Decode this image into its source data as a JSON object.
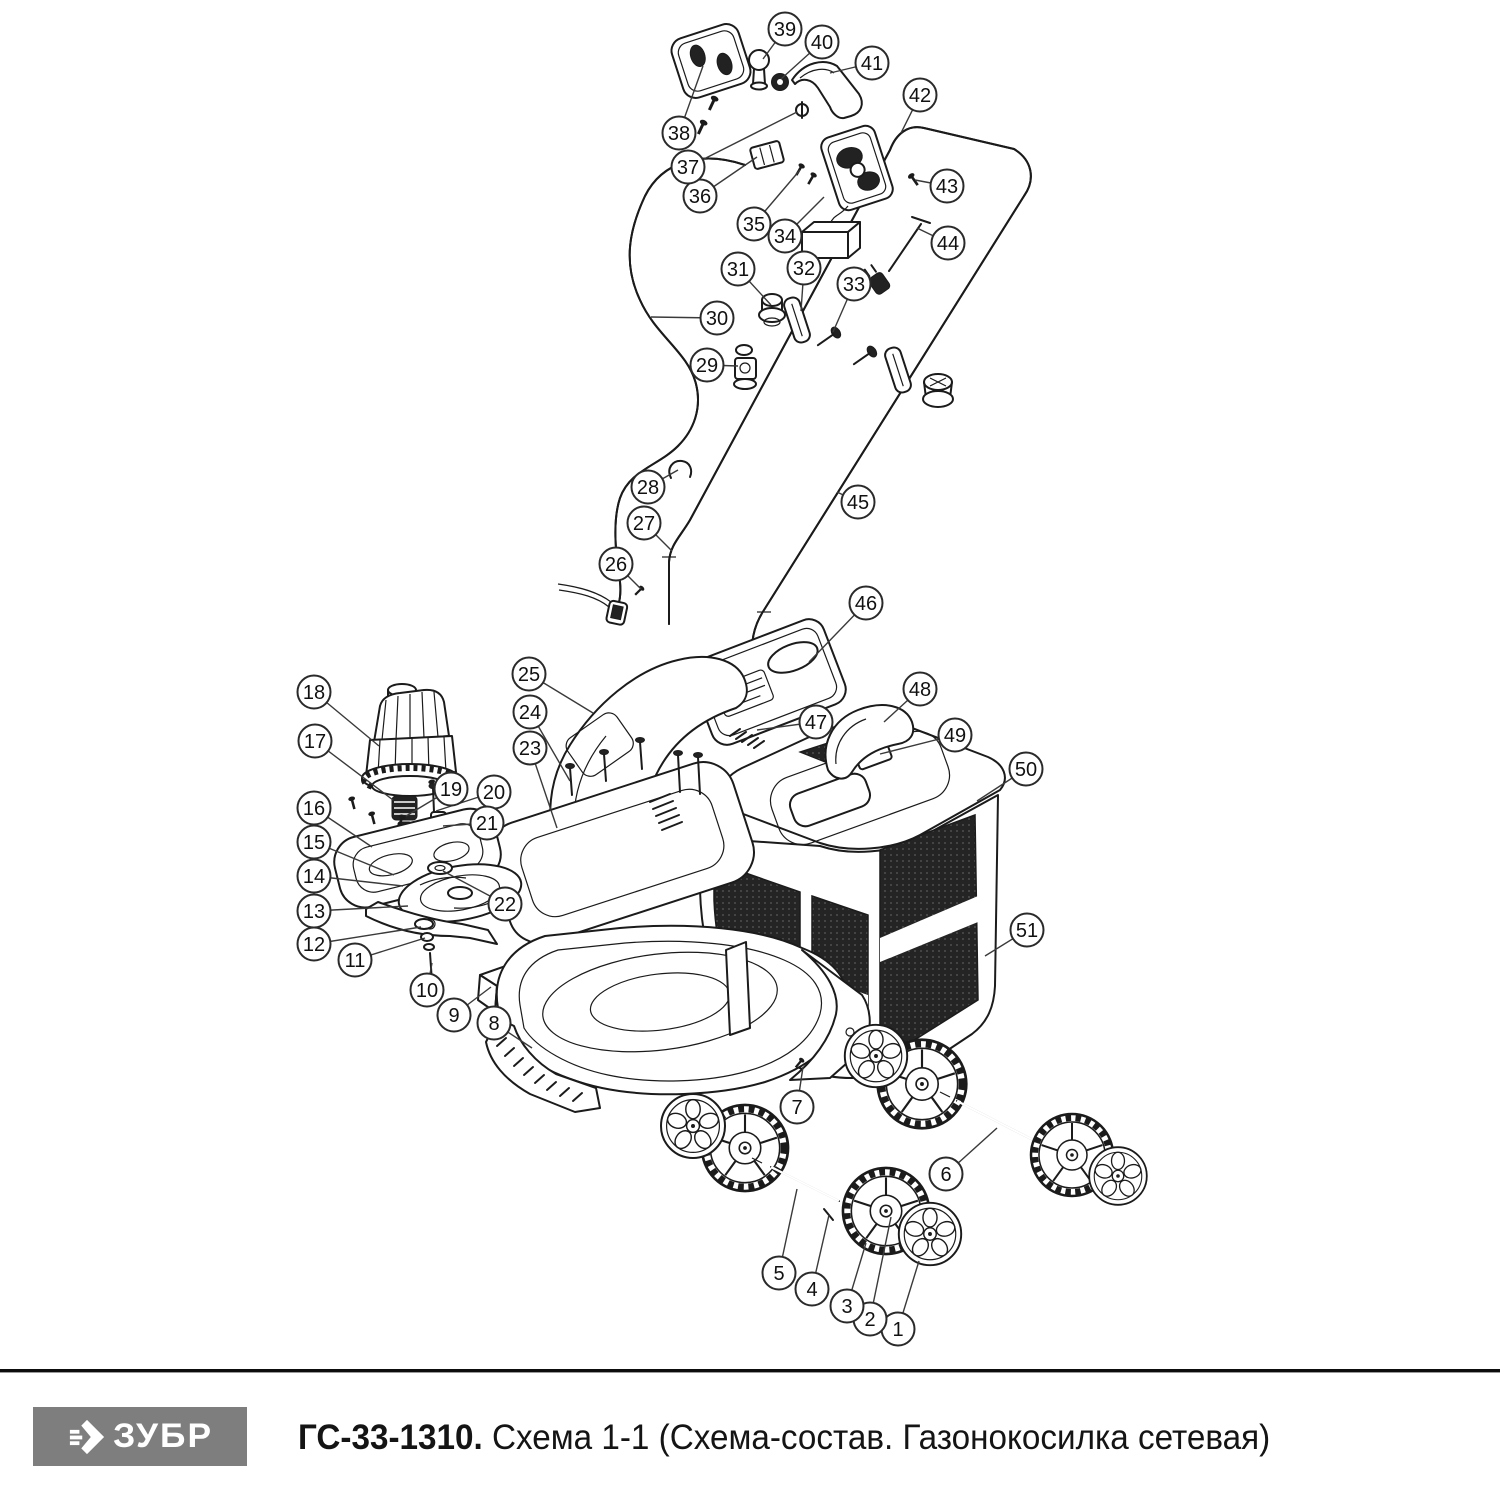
{
  "footer": {
    "brand": "ЗУБР",
    "model": "ГС-33-1310.",
    "scheme_title": " Схема 1-1 (Схема-состав. Газонокосилка сетевая)",
    "brand_bg": "#7e7e7e",
    "brand_fg": "#ffffff"
  },
  "diagram": {
    "kind": "exploded-parts-diagram",
    "subject": "Газонокосилка сетевая",
    "callout_style": {
      "radius": 16.5,
      "circle_color": "#2a2a2a",
      "text_color": "#111111",
      "leader_color": "#3a3a3a"
    },
    "callouts": [
      {
        "n": 1,
        "cx": 898,
        "cy": 1329,
        "tx": 919,
        "ty": 1261
      },
      {
        "n": 2,
        "cx": 870,
        "cy": 1319,
        "tx": 891,
        "ty": 1217
      },
      {
        "n": 3,
        "cx": 847,
        "cy": 1306,
        "tx": 866,
        "ty": 1243
      },
      {
        "n": 4,
        "cx": 812,
        "cy": 1289,
        "tx": 829,
        "ty": 1215
      },
      {
        "n": 5,
        "cx": 779,
        "cy": 1273,
        "tx": 797,
        "ty": 1189
      },
      {
        "n": 6,
        "cx": 946,
        "cy": 1174,
        "tx": 997,
        "ty": 1128
      },
      {
        "n": 7,
        "cx": 797,
        "cy": 1107,
        "tx": 803,
        "ty": 1067
      },
      {
        "n": 8,
        "cx": 494,
        "cy": 1023,
        "tx": 532,
        "ty": 1048
      },
      {
        "n": 9,
        "cx": 454,
        "cy": 1015,
        "tx": 491,
        "ty": 987
      },
      {
        "n": 10,
        "cx": 427,
        "cy": 990,
        "tx": 432,
        "ty": 963
      },
      {
        "n": 11,
        "cx": 355,
        "cy": 960,
        "tx": 425,
        "ty": 938
      },
      {
        "n": 12,
        "cx": 314,
        "cy": 944,
        "tx": 421,
        "ty": 927
      },
      {
        "n": 13,
        "cx": 314,
        "cy": 911,
        "tx": 408,
        "ty": 906
      },
      {
        "n": 14,
        "cx": 314,
        "cy": 876,
        "tx": 403,
        "ty": 886
      },
      {
        "n": 15,
        "cx": 314,
        "cy": 842,
        "tx": 394,
        "ty": 875
      },
      {
        "n": 16,
        "cx": 314,
        "cy": 808,
        "tx": 372,
        "ty": 847
      },
      {
        "n": 17,
        "cx": 315,
        "cy": 741,
        "tx": 393,
        "ty": 800
      },
      {
        "n": 18,
        "cx": 314,
        "cy": 692,
        "tx": 379,
        "ty": 746
      },
      {
        "n": 19,
        "cx": 451,
        "cy": 789,
        "tx": 406,
        "ty": 816
      },
      {
        "n": 20,
        "cx": 494,
        "cy": 792,
        "tx": 436,
        "ty": 811
      },
      {
        "n": 21,
        "cx": 487,
        "cy": 823,
        "tx": 443,
        "ty": 826
      },
      {
        "n": 22,
        "cx": 505,
        "cy": 904,
        "tx": 443,
        "ty": 871
      },
      {
        "n": 23,
        "cx": 530,
        "cy": 748,
        "tx": 557,
        "ty": 828
      },
      {
        "n": 24,
        "cx": 530,
        "cy": 712,
        "tx": 570,
        "ty": 781
      },
      {
        "n": 25,
        "cx": 529,
        "cy": 674,
        "tx": 593,
        "ty": 713
      },
      {
        "n": 26,
        "cx": 616,
        "cy": 564,
        "tx": 641,
        "ty": 589
      },
      {
        "n": 27,
        "cx": 644,
        "cy": 523,
        "tx": 672,
        "ty": 551
      },
      {
        "n": 28,
        "cx": 648,
        "cy": 487,
        "tx": 678,
        "ty": 470
      },
      {
        "n": 29,
        "cx": 707,
        "cy": 365,
        "tx": 738,
        "ty": 366
      },
      {
        "n": 30,
        "cx": 717,
        "cy": 318,
        "tx": 651,
        "ty": 317
      },
      {
        "n": 31,
        "cx": 738,
        "cy": 269,
        "tx": 771,
        "ty": 305
      },
      {
        "n": 32,
        "cx": 804,
        "cy": 268,
        "tx": 801,
        "ty": 311
      },
      {
        "n": 33,
        "cx": 854,
        "cy": 284,
        "tx": 833,
        "ty": 332
      },
      {
        "n": 34,
        "cx": 785,
        "cy": 236,
        "tx": 824,
        "ty": 197
      },
      {
        "n": 35,
        "cx": 754,
        "cy": 224,
        "tx": 800,
        "ty": 170
      },
      {
        "n": 36,
        "cx": 700,
        "cy": 196,
        "tx": 757,
        "ty": 157
      },
      {
        "n": 37,
        "cx": 688,
        "cy": 167,
        "tx": 797,
        "ty": 112
      },
      {
        "n": 38,
        "cx": 679,
        "cy": 133,
        "tx": 703,
        "ty": 66
      },
      {
        "n": 39,
        "cx": 785,
        "cy": 29,
        "tx": 763,
        "ty": 59
      },
      {
        "n": 40,
        "cx": 822,
        "cy": 42,
        "tx": 781,
        "ty": 79
      },
      {
        "n": 41,
        "cx": 872,
        "cy": 63,
        "tx": 830,
        "ty": 73
      },
      {
        "n": 42,
        "cx": 920,
        "cy": 95,
        "tx": 901,
        "ty": 133
      },
      {
        "n": 43,
        "cx": 947,
        "cy": 186,
        "tx": 915,
        "ty": 180
      },
      {
        "n": 44,
        "cx": 948,
        "cy": 243,
        "tx": 917,
        "ty": 228
      },
      {
        "n": 45,
        "cx": 858,
        "cy": 502,
        "tx": 837,
        "ty": 492
      },
      {
        "n": 46,
        "cx": 866,
        "cy": 603,
        "tx": 809,
        "ty": 662
      },
      {
        "n": 47,
        "cx": 816,
        "cy": 722,
        "tx": 757,
        "ty": 730
      },
      {
        "n": 48,
        "cx": 920,
        "cy": 689,
        "tx": 884,
        "ty": 722
      },
      {
        "n": 49,
        "cx": 955,
        "cy": 735,
        "tx": 880,
        "ty": 754
      },
      {
        "n": 50,
        "cx": 1026,
        "cy": 769,
        "tx": 977,
        "ty": 801
      },
      {
        "n": 51,
        "cx": 1027,
        "cy": 930,
        "tx": 985,
        "ty": 956
      }
    ]
  }
}
